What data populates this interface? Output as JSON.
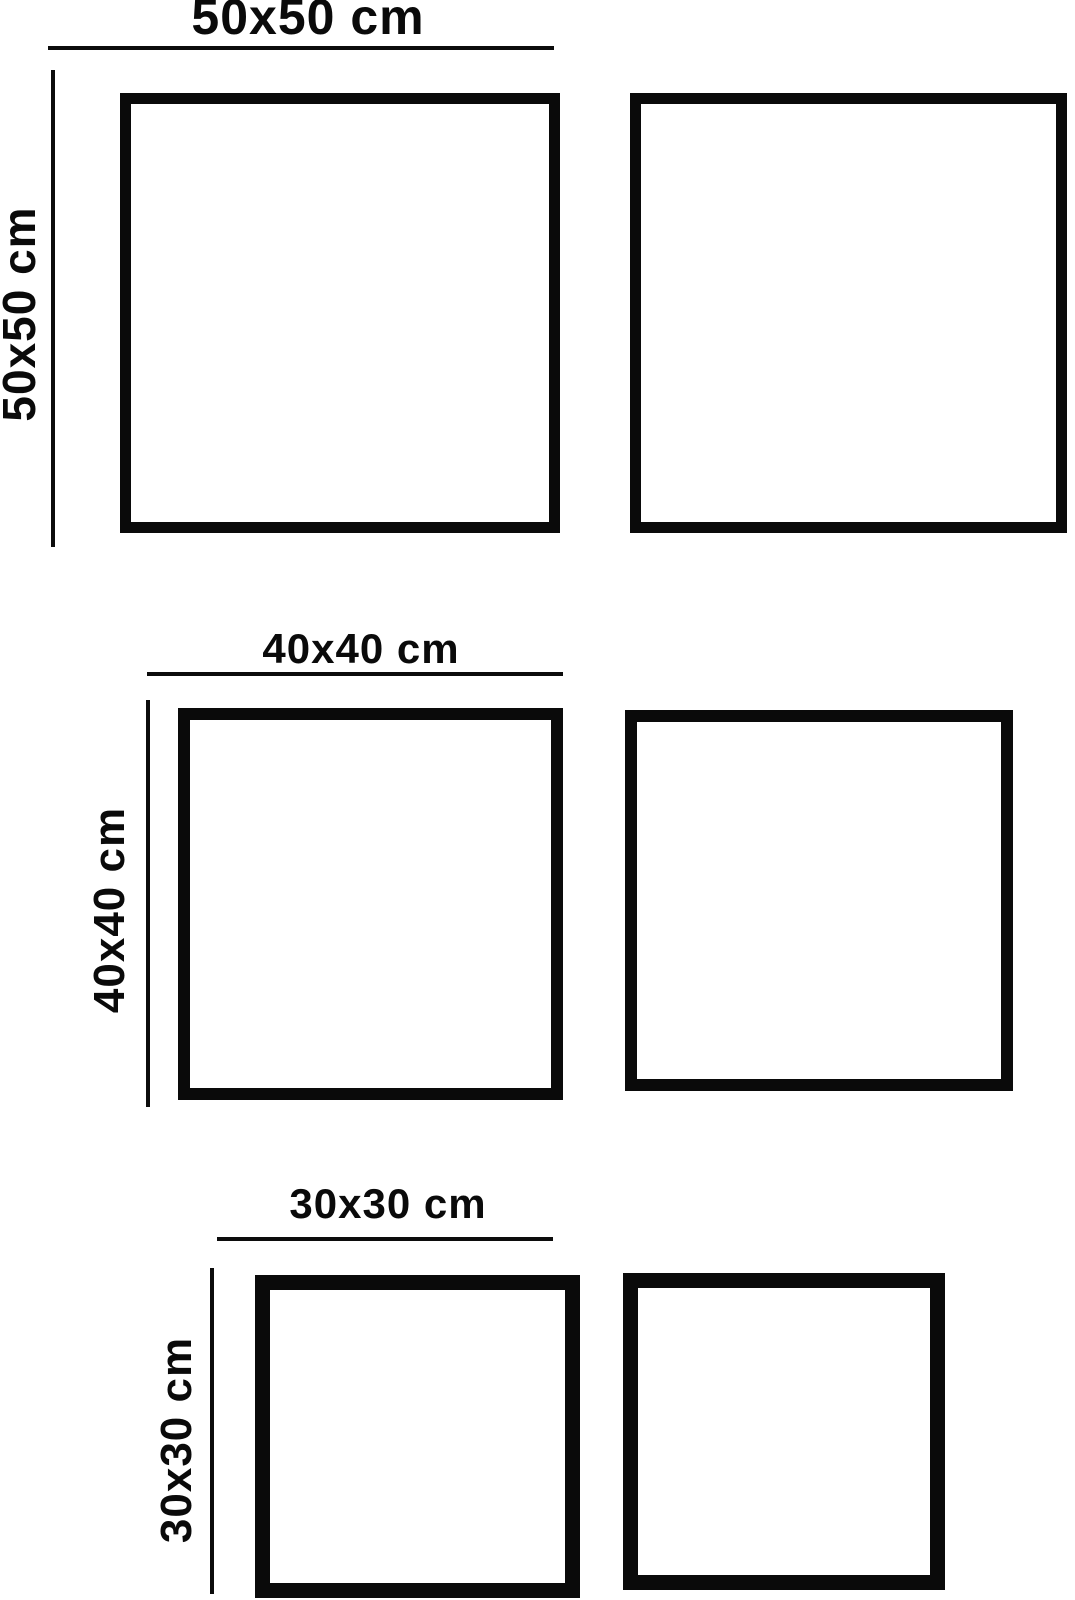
{
  "page": {
    "background_color": "#ffffff",
    "ink_color": "#0a0a0a",
    "description": "Size comparison diagram with three pairs of square frames and dimension lines"
  },
  "rows": [
    {
      "size_cm": "50x50",
      "top_label": "50x50 cm",
      "side_label": "50x50 cm",
      "squares_count": 2
    },
    {
      "size_cm": "40x40",
      "top_label": "40x40 cm",
      "side_label": "40x40 cm",
      "squares_count": 2
    },
    {
      "size_cm": "30x30",
      "top_label": "30x30 cm",
      "side_label": "30x30 cm",
      "squares_count": 2
    }
  ]
}
